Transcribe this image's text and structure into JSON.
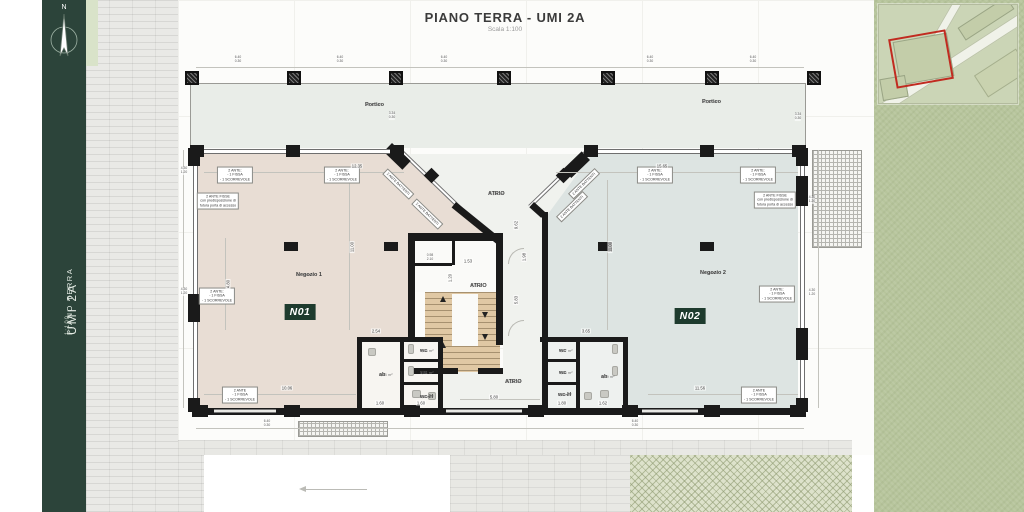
{
  "header": {
    "title": "PIANO TERRA - UMI 2A",
    "scale": "Scala 1:100"
  },
  "sidebar": {
    "project": "UMI 2A",
    "level": "PIANO TERRA",
    "scale": "1:100",
    "compass_label": "N"
  },
  "colors": {
    "sidebar_green": "#2c443a",
    "shop1_fill": "#e8ddd4",
    "shop2_fill": "#dde4e2",
    "stair_fill": "#e0c8a4",
    "portico_fill": "#e9ede8",
    "wall_black": "#1a1a1a",
    "badge_bg": "#1e3b2e",
    "grass_green": "#b7c59c",
    "map_bg": "#cbd5b6",
    "site_outline_red": "#c12b20"
  },
  "plan": {
    "room_labels": [
      {
        "name": "Portico",
        "area": "44,20 m²",
        "x": 365,
        "y": 102
      },
      {
        "name": "Portico",
        "area": "50,47 m²",
        "x": 702,
        "y": 99
      },
      {
        "name": "Negozio 1",
        "area": "190,86 m²",
        "x": 296,
        "y": 272
      },
      {
        "name": "Negozio 2",
        "area": "217,78 m²",
        "x": 700,
        "y": 270
      },
      {
        "name": "ATRIO",
        "area": "71,31 m²",
        "x": 488,
        "y": 191
      },
      {
        "name": "ATRIO",
        "area": "7,37 m²",
        "x": 470,
        "y": 283
      },
      {
        "name": "ATRIO",
        "area": "14,28 m²",
        "x": 505,
        "y": 379
      },
      {
        "name": "wc",
        "area": "1,74 m²",
        "x": 420,
        "y": 348
      },
      {
        "name": "wc",
        "area": "1,31 m²",
        "x": 420,
        "y": 370
      },
      {
        "name": "wc-H",
        "area": "3,23 m²",
        "x": 420,
        "y": 394
      },
      {
        "name": "ab",
        "area": "4,13 m²",
        "x": 379,
        "y": 372
      },
      {
        "name": "wc",
        "area": "1,37 m²",
        "x": 559,
        "y": 348
      },
      {
        "name": "wc",
        "area": "1,26 m²",
        "x": 559,
        "y": 370
      },
      {
        "name": "wc-H",
        "area": "3,34 m²",
        "x": 558,
        "y": 392
      },
      {
        "name": "ab",
        "area": "4,89 m²",
        "x": 601,
        "y": 374
      }
    ],
    "badges": [
      {
        "label": "N01",
        "x": 300,
        "y": 312
      },
      {
        "label": "N02",
        "x": 690,
        "y": 316
      }
    ],
    "annotations": [
      {
        "lines": [
          "2 ANTE:",
          "- 1 FISSA",
          "- 1 SCORREVOLE"
        ],
        "x": 235,
        "y": 175,
        "rot": 0
      },
      {
        "lines": [
          "2 ANTE:",
          "- 1 FISSA",
          "- 1 SCORREVOLE"
        ],
        "x": 342,
        "y": 175,
        "rot": 0
      },
      {
        "lines": [
          "2 ANTE FISSE",
          "con predisposizione di",
          "futura porta di accesso"
        ],
        "x": 218,
        "y": 201,
        "rot": 0
      },
      {
        "lines": [
          "2 ANTE:",
          "- 1 FISSA",
          "- 1 SCORREVOLE"
        ],
        "x": 217,
        "y": 296,
        "rot": 0
      },
      {
        "lines": [
          "2 ANTE BATTENTI"
        ],
        "x": 398,
        "y": 184,
        "rot": 44
      },
      {
        "lines": [
          "2 ANTE BATTENTI"
        ],
        "x": 427,
        "y": 214,
        "rot": 44
      },
      {
        "lines": [
          "2 ANTE BATTENTI"
        ],
        "x": 584,
        "y": 184,
        "rot": -44
      },
      {
        "lines": [
          "2 ANTE BATTENTI"
        ],
        "x": 572,
        "y": 207,
        "rot": -44
      },
      {
        "lines": [
          "2 ANTE:",
          "- 1 FISSA",
          "- 1 SCORREVOLE"
        ],
        "x": 655,
        "y": 175,
        "rot": 0
      },
      {
        "lines": [
          "2 ANTE:",
          "- 1 FISSA",
          "- 1 SCORREVOLE"
        ],
        "x": 758,
        "y": 175,
        "rot": 0
      },
      {
        "lines": [
          "2 ANTE FISSE",
          "con predisposizione di",
          "futura porta di accesso"
        ],
        "x": 775,
        "y": 200,
        "rot": 0
      },
      {
        "lines": [
          "2 ANTE:",
          "- 1 FISSA",
          "- 1 SCORREVOLE"
        ],
        "x": 777,
        "y": 294,
        "rot": 0
      },
      {
        "lines": [
          "2 ANTE",
          "- 1 FISSA",
          "- 1 SCORREVOLE"
        ],
        "x": 240,
        "y": 395,
        "rot": 0
      },
      {
        "lines": [
          "2 ANTE",
          "- 1 FISSA",
          "- 1 SCORREVOLE"
        ],
        "x": 759,
        "y": 395,
        "rot": 0
      }
    ],
    "dimensions": [
      {
        "text": "12.35",
        "x": 357,
        "y": 166,
        "rot": 0
      },
      {
        "text": "15.65",
        "x": 662,
        "y": 166,
        "rot": 0
      },
      {
        "text": "11.00",
        "x": 352,
        "y": 247,
        "rot": -90
      },
      {
        "text": "11.00",
        "x": 610,
        "y": 247,
        "rot": -90
      },
      {
        "text": "4.80",
        "x": 228,
        "y": 284,
        "rot": -90
      },
      {
        "text": "2.54",
        "x": 376,
        "y": 331,
        "rot": 0
      },
      {
        "text": "3.65",
        "x": 586,
        "y": 331,
        "rot": 0
      },
      {
        "text": "1.53",
        "x": 468,
        "y": 261,
        "rot": 0
      },
      {
        "text": "1.20",
        "x": 450,
        "y": 278,
        "rot": -90
      },
      {
        "text": "9.62",
        "x": 516,
        "y": 225,
        "rot": -90
      },
      {
        "text": "5.83",
        "x": 516,
        "y": 300,
        "rot": -90
      },
      {
        "text": "1.98",
        "x": 524,
        "y": 257,
        "rot": -90
      },
      {
        "text": "10.06",
        "x": 287,
        "y": 388,
        "rot": 0
      },
      {
        "text": "5.80",
        "x": 494,
        "y": 397,
        "rot": 0
      },
      {
        "text": "11.56",
        "x": 700,
        "y": 388,
        "rot": 0
      },
      {
        "text": "1.60",
        "x": 380,
        "y": 403,
        "rot": 0
      },
      {
        "text": "1.60",
        "x": 421,
        "y": 403,
        "rot": 0
      },
      {
        "text": "1.80",
        "x": 562,
        "y": 403,
        "rot": 0
      },
      {
        "text": "1.62",
        "x": 603,
        "y": 403,
        "rot": 0
      }
    ],
    "dim_pairs": [
      {
        "a": "6.40",
        "b": "0.30",
        "x": 238,
        "y": 60
      },
      {
        "a": "6.40",
        "b": "0.30",
        "x": 340,
        "y": 60
      },
      {
        "a": "6.40",
        "b": "0.30",
        "x": 444,
        "y": 60
      },
      {
        "a": "6.40",
        "b": "0.30",
        "x": 650,
        "y": 60
      },
      {
        "a": "6.40",
        "b": "0.30",
        "x": 753,
        "y": 60
      },
      {
        "a": "3.34",
        "b": "0.30",
        "x": 392,
        "y": 116
      },
      {
        "a": "3.34",
        "b": "0.30",
        "x": 798,
        "y": 117
      },
      {
        "a": "4.30",
        "b": "1.20",
        "x": 184,
        "y": 171
      },
      {
        "a": "4.30",
        "b": "1.20",
        "x": 184,
        "y": 292
      },
      {
        "a": "4.30",
        "b": "1.20",
        "x": 812,
        "y": 200
      },
      {
        "a": "4.30",
        "b": "1.20",
        "x": 812,
        "y": 293
      },
      {
        "a": "0.98",
        "b": "2.10",
        "x": 430,
        "y": 258
      },
      {
        "a": "6.40",
        "b": "0.30",
        "x": 267,
        "y": 424
      },
      {
        "a": "6.40",
        "b": "0.30",
        "x": 635,
        "y": 424
      }
    ]
  }
}
